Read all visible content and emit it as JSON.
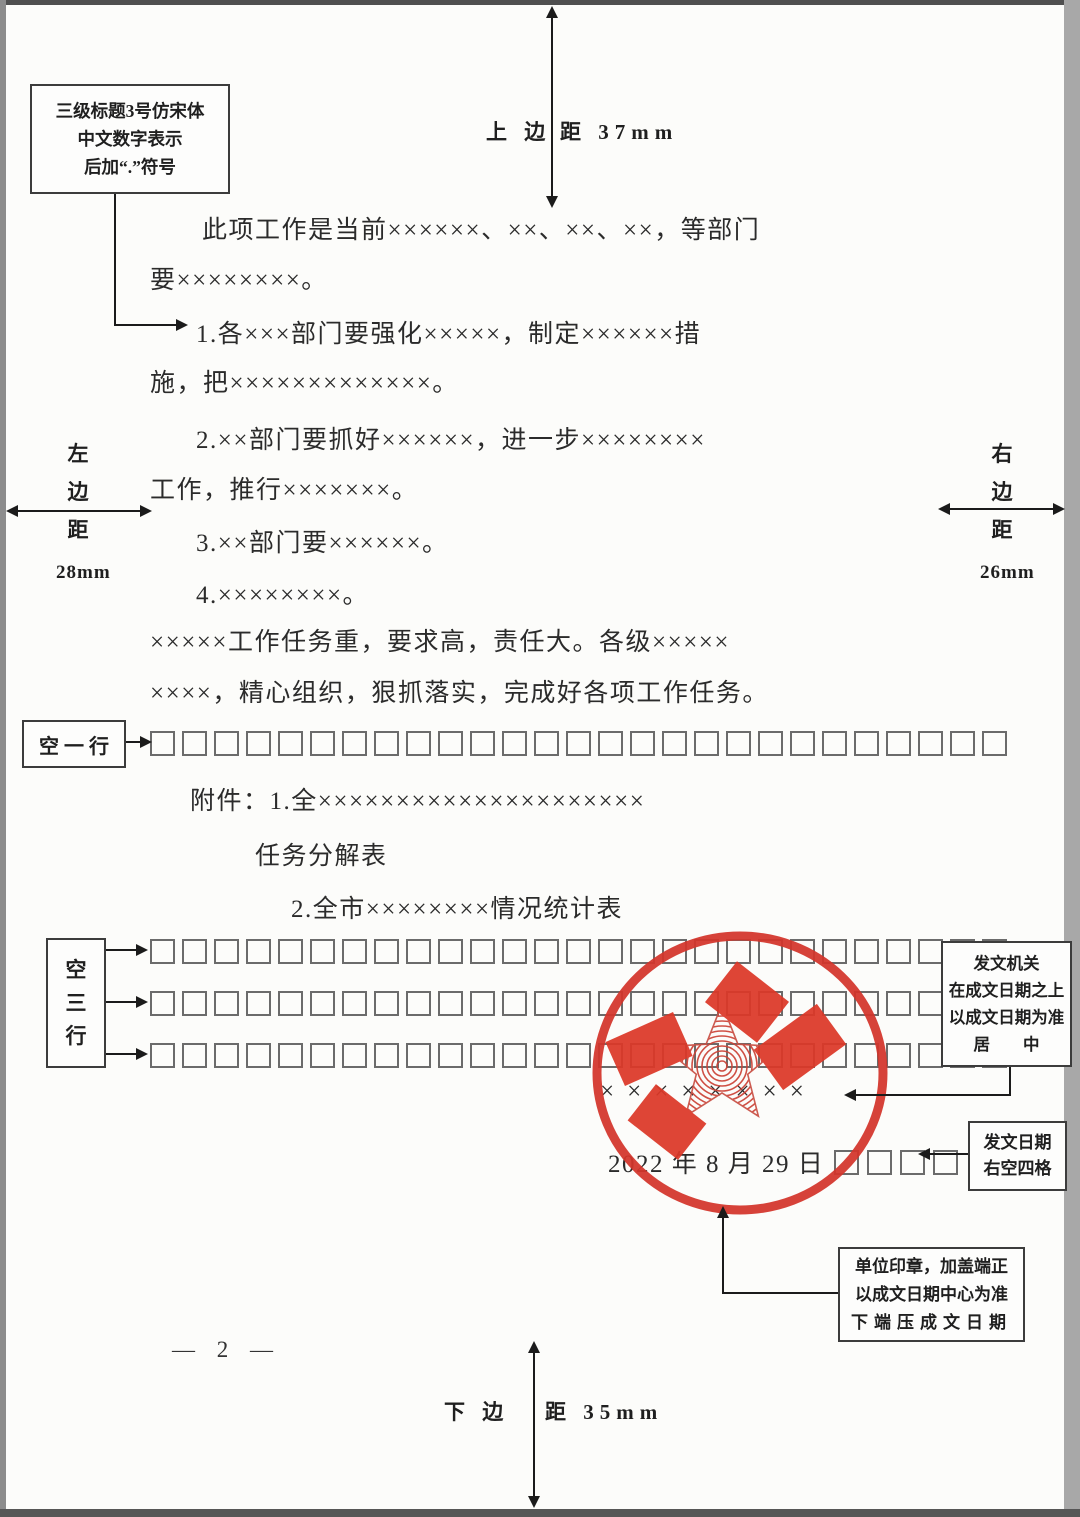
{
  "annotations": {
    "heading_note": {
      "lines": [
        "三级标题3号仿宋体",
        "中文数字表示",
        "后加“.”符号"
      ]
    },
    "top_margin": {
      "left": "上 边",
      "right": "距 37mm"
    },
    "bottom_margin": {
      "left": "下 边",
      "right": "距 35mm"
    },
    "left_margin": {
      "chars": [
        "左",
        "边",
        "距"
      ],
      "value": "28mm"
    },
    "right_margin": {
      "chars": [
        "右",
        "边",
        "距"
      ],
      "value": "26mm"
    },
    "blank_one": {
      "label": "空 一 行"
    },
    "blank_three": {
      "chars": [
        "空",
        "三",
        "行"
      ]
    },
    "issuer_note": {
      "lines": [
        "发文机关",
        "在成文日期之上",
        "以成文日期为准",
        "居        中"
      ]
    },
    "date_note": {
      "lines": [
        "发文日期",
        "右空四格"
      ]
    },
    "seal_note": {
      "lines": [
        "单位印章，加盖端正",
        "以成文日期中心为准",
        "下端压成文日期"
      ]
    }
  },
  "body": {
    "lines": [
      {
        "text": "此项工作是当前××××××、××、××、××，等部门"
      },
      {
        "text": "要××××××××。"
      },
      {
        "text": "1.各×××部门要强化×××××，制定××××××措"
      },
      {
        "text": "施，把×××××××××××××。"
      },
      {
        "text": "2.××部门要抓好××××××，进一步××××××××"
      },
      {
        "text": "工作，推行×××××××。"
      },
      {
        "text": "3.××部门要××××××。"
      },
      {
        "text": "4.××××××××。"
      },
      {
        "text": "×××××工作任务重，要求高，责任大。各级×××××"
      },
      {
        "text": "××××，精心组织，狠抓落实，完成好各项工作任务。"
      }
    ],
    "attachments": [
      {
        "text": "附件：1.全×××××××××××××××××××××"
      },
      {
        "text": "任务分解表"
      },
      {
        "text": "2.全市××××××××情况统计表"
      }
    ]
  },
  "signature": {
    "authority_placeholder": "××××××××",
    "date": "2022 年 8 月 29 日",
    "date_trailing_squares": 4
  },
  "blank_rows": {
    "cells_per_row": 27
  },
  "page_number": "— 2 —",
  "colors": {
    "seal_red": "#d4352b",
    "block_red": "#dc3828",
    "ink": "#2b2b2b"
  }
}
